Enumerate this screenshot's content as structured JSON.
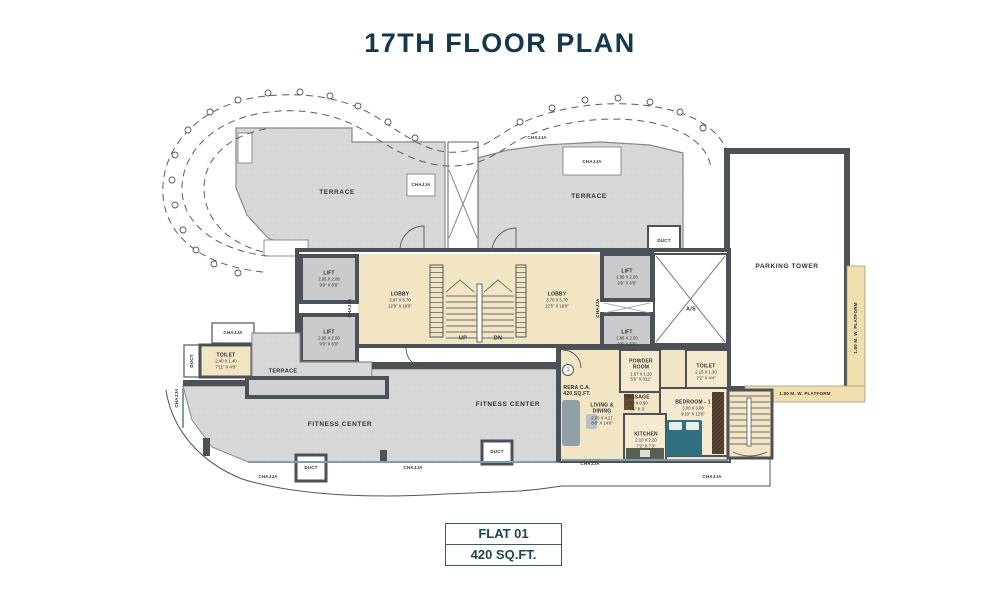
{
  "title": "17TH FLOOR PLAN",
  "plan": {
    "labels": {
      "terrace": "TERRACE",
      "chajja": "CHAJJA",
      "duct": "DUCT",
      "parking": "PARKING TOWER",
      "fitness": "FITNESS CENTER",
      "as_shaft": "A/S",
      "up": "UP",
      "dn": "DN",
      "platform": "1.80 M. W. PLATFORM",
      "rera1": "RERA C.A.",
      "rera2": "420 SQ.FT.",
      "unit_no": "1"
    },
    "rooms": {
      "lifts": [
        {
          "name": "LIFT",
          "m": "2.95 X 2.08",
          "ft": "9'9\" X 6'8\""
        },
        {
          "name": "LIFT",
          "m": "2.95 X 2.08",
          "ft": "9'9\" X 6'8\""
        },
        {
          "name": "LIFT",
          "m": "2.95 X 2.08",
          "ft": "9'9\" X 6'8\""
        },
        {
          "name": "LIFT",
          "m": "2.85 X 2.00",
          "ft": "9'8\" X 6'8\""
        }
      ],
      "lobby_l": {
        "name": "LOBBY",
        "m": "3.87 X 5.70",
        "ft": "12'9\" X 18'8\""
      },
      "lobby_r": {
        "name": "LOBBY",
        "m": "3.78 X 5.70",
        "ft": "12'5\" X 18'9\""
      },
      "toilet_l": {
        "name": "TOILET",
        "m": "2.40 X 1.40",
        "ft": "7'11\" X 4'8\""
      },
      "powder": {
        "name": "POWDER ROOM",
        "m": "1.67 X 1.20",
        "ft": "5'6\" X 3'11\""
      },
      "passage": {
        "name": "PASSAGE",
        "m": "2.30 X 0.90",
        "ft": "7'6\" X 3'"
      },
      "living": {
        "name": "LIVING & DINING",
        "m": "2.65 X 4.27",
        "ft": "8'8\" X 14'0\""
      },
      "kitchen": {
        "name": "KITCHEN",
        "m": "2.10 X 2.20",
        "ft": "7'2\" X 7'3\""
      },
      "bedroom": {
        "name": "BEDROOM - 1",
        "m": "3.00 X 3.88",
        "ft": "9'10\" X 12'8\""
      },
      "toilet_r": {
        "name": "TOILET",
        "m": "2.15 X 1.30",
        "ft": "7'2\" X 4'4\""
      }
    }
  },
  "footer": {
    "flat": "FLAT 01",
    "area": "420 SQ.FT."
  },
  "colors": {
    "accent": "#133850",
    "wall": "#4c5157",
    "terrace": "#d6d8da",
    "floor": "#f2e5c3",
    "platform": "#f0dfad",
    "window": "#7d9db0"
  }
}
